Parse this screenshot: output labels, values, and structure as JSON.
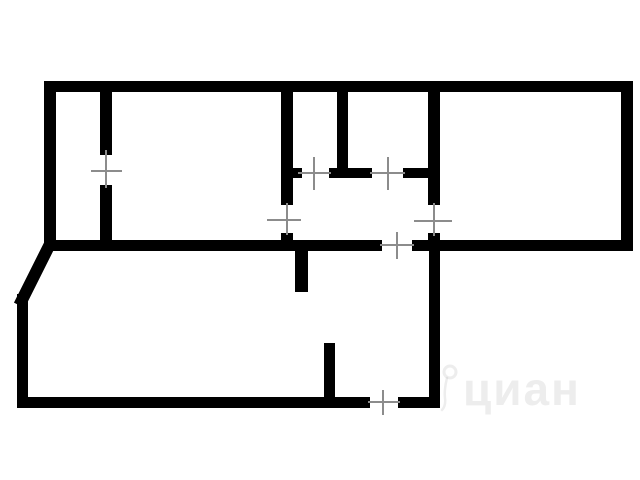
{
  "plan": {
    "background_color": "#ffffff",
    "wall_color": "#000000",
    "tick_color": "#8c8c8c",
    "tick_width": 2,
    "walls": [
      {
        "name": "exterior-top-wall",
        "rect": [
          44,
          81,
          589,
          11
        ]
      },
      {
        "name": "exterior-left-wall-upper",
        "rect": [
          44,
          81,
          12,
          169
        ]
      },
      {
        "name": "exterior-right-wall",
        "rect": [
          621,
          81,
          12,
          169
        ]
      },
      {
        "name": "mid-wall-left-segment",
        "rect": [
          44,
          240,
          338,
          11
        ]
      },
      {
        "name": "mid-wall-right-segment",
        "rect": [
          412,
          240,
          221,
          11
        ]
      },
      {
        "name": "exterior-left-wall-lower",
        "rect": [
          17,
          294,
          11,
          114
        ]
      },
      {
        "name": "exterior-bottom-wall-left",
        "rect": [
          17,
          397,
          353,
          11
        ]
      },
      {
        "name": "exterior-bottom-wall-right",
        "rect": [
          398,
          397,
          42,
          11
        ]
      },
      {
        "name": "exterior-right-wall-lower",
        "rect": [
          429,
          250,
          11,
          158
        ]
      },
      {
        "name": "room-divider-upper",
        "rect": [
          100,
          91,
          12,
          64
        ]
      },
      {
        "name": "room-divider-lower",
        "rect": [
          100,
          185,
          12,
          60
        ]
      },
      {
        "name": "hallway-left-wall-upper",
        "rect": [
          281,
          91,
          12,
          114
        ]
      },
      {
        "name": "hallway-left-wall-lower",
        "rect": [
          281,
          233,
          12,
          12
        ]
      },
      {
        "name": "bath-doorway-stub",
        "rect": [
          293,
          168,
          9,
          10
        ]
      },
      {
        "name": "bath-bottom-wall-middle",
        "rect": [
          329,
          168,
          43,
          10
        ]
      },
      {
        "name": "bath-bottom-wall-right",
        "rect": [
          403,
          168,
          37,
          10
        ]
      },
      {
        "name": "bath-wc-divider",
        "rect": [
          337,
          91,
          11,
          87
        ]
      },
      {
        "name": "hallway-right-wall-upper",
        "rect": [
          428,
          91,
          12,
          114
        ]
      },
      {
        "name": "hallway-right-wall-lower",
        "rect": [
          428,
          233,
          12,
          12
        ]
      },
      {
        "name": "partition-stub-below-mid-wall",
        "rect": [
          295,
          250,
          13,
          42
        ]
      },
      {
        "name": "partition-stub-above-bottom",
        "rect": [
          324,
          343,
          11,
          58
        ]
      }
    ],
    "diagonal_wall": {
      "name": "diagonal-corner-wall",
      "x1": 50,
      "y1": 244,
      "x2": 22,
      "y2": 300,
      "stroke_width": 12
    },
    "door_marks": [
      {
        "name": "door-left-room-divider",
        "line": [
          106,
          150,
          106,
          188
        ],
        "dash": [
          91,
          171,
          122,
          171
        ]
      },
      {
        "name": "door-hallway-left",
        "line": [
          287,
          203,
          287,
          235
        ],
        "dash": [
          267,
          220,
          301,
          220
        ]
      },
      {
        "name": "door-hallway-right",
        "line": [
          434,
          203,
          434,
          236
        ],
        "dash": [
          414,
          221,
          452,
          221
        ]
      },
      {
        "name": "door-wc",
        "line": [
          298,
          173,
          331,
          173
        ],
        "dash": [
          314,
          157,
          314,
          190
        ]
      },
      {
        "name": "door-bathroom",
        "line": [
          370,
          173,
          405,
          173
        ],
        "dash": [
          388,
          157,
          388,
          190
        ]
      },
      {
        "name": "door-hallway-bottom",
        "line": [
          380,
          245,
          414,
          245
        ],
        "dash": [
          397,
          232,
          397,
          259
        ]
      },
      {
        "name": "door-exterior-bottom",
        "line": [
          368,
          402,
          400,
          402
        ],
        "dash": [
          383,
          390,
          383,
          415
        ]
      }
    ]
  },
  "watermark": {
    "text": "циан",
    "color": "rgba(180,180,180,0.24)",
    "left": 437,
    "top": 360,
    "font_size": 46,
    "letter_spacing": 2,
    "pin": {
      "circle_cx": 13,
      "circle_cy": 12,
      "circle_r": 6,
      "ring_width": 3,
      "tail_path": "M 10 18 Q 7 30 8 38 Q 9 46 5 50",
      "tail_width": 2.5,
      "width": 26,
      "height": 52
    }
  }
}
